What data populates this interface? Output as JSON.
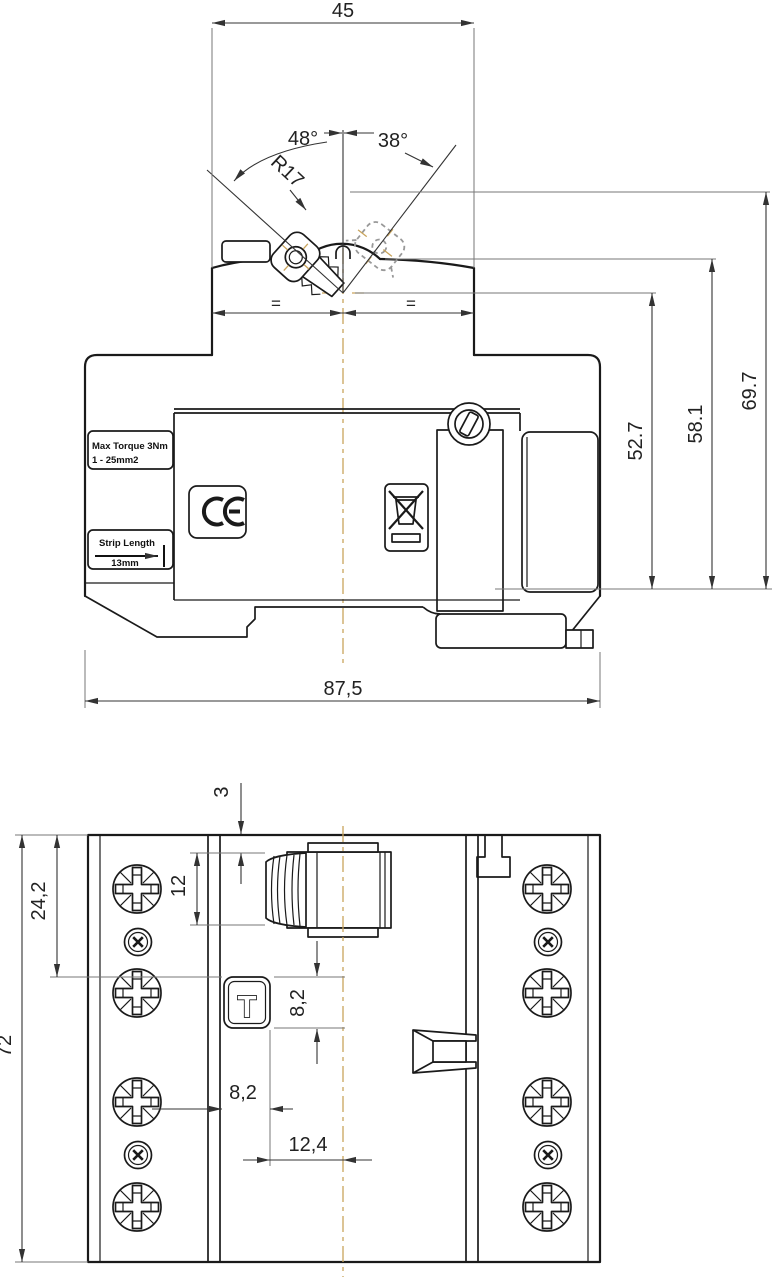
{
  "front_view": {
    "dim_module_width": "45",
    "dim_angle_left": "48°",
    "dim_angle_right": "38°",
    "dim_lever_radius": "R17",
    "dim_equal_left": "=",
    "dim_equal_right": "=",
    "dim_height_pivot": "52.7",
    "dim_height_upper": "58.1",
    "dim_height_total": "69.7",
    "dim_total_width": "87,5",
    "torque_label_line1": "Max Torque 3Nm",
    "torque_label_line2": "1 - 25mm2",
    "ce_mark": "CE",
    "strip_label_line1": "Strip Length",
    "strip_label_line2": "13mm"
  },
  "top_view": {
    "dim_toggle_inset": "3",
    "dim_toggle_length": "12",
    "dim_row_offset": "24,2",
    "dim_depth": "72",
    "dim_test_height": "8,2",
    "dim_test_offset": "8,2",
    "dim_test_center": "12,4",
    "test_button": "T"
  },
  "colors": {
    "line": "#1a1a1a",
    "dimension": "#333333",
    "centerline": "#c9a45c",
    "ghost_position": "#999999"
  }
}
